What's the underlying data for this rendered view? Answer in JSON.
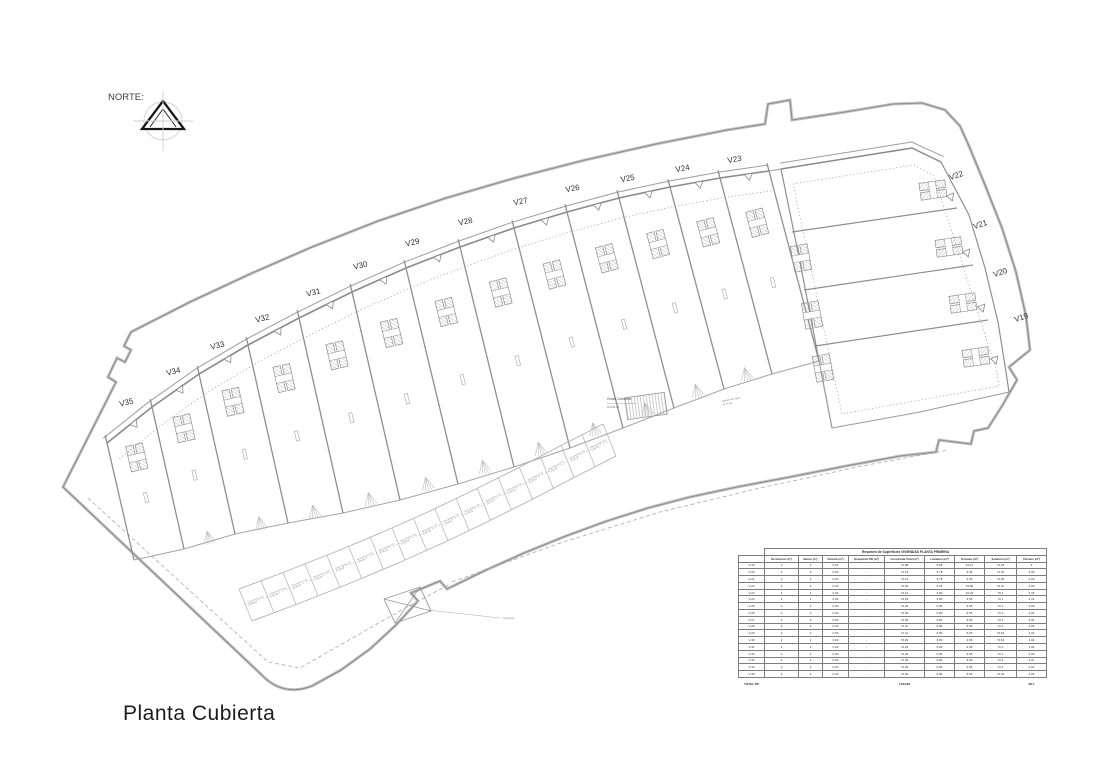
{
  "page": {
    "title_label": "Planta Cubierta",
    "north_label": "NORTE:"
  },
  "plan": {
    "villa_labels": [
      {
        "id": "V19",
        "x": 1022,
        "y": 320,
        "rot": -18
      },
      {
        "id": "V20",
        "x": 1001,
        "y": 275,
        "rot": -18
      },
      {
        "id": "V21",
        "x": 981,
        "y": 227,
        "rot": -18
      },
      {
        "id": "V22",
        "x": 957,
        "y": 178,
        "rot": -18
      },
      {
        "id": "V23",
        "x": 735,
        "y": 162,
        "rot": -10
      },
      {
        "id": "V24",
        "x": 683,
        "y": 171,
        "rot": -10
      },
      {
        "id": "V25",
        "x": 628,
        "y": 181,
        "rot": -10
      },
      {
        "id": "V26",
        "x": 573,
        "y": 191,
        "rot": -10
      },
      {
        "id": "V27",
        "x": 521,
        "y": 204,
        "rot": -11
      },
      {
        "id": "V28",
        "x": 466,
        "y": 224,
        "rot": -12
      },
      {
        "id": "V29",
        "x": 413,
        "y": 245,
        "rot": -13
      },
      {
        "id": "V30",
        "x": 361,
        "y": 268,
        "rot": -13
      },
      {
        "id": "V31",
        "x": 314,
        "y": 295,
        "rot": -14
      },
      {
        "id": "V32",
        "x": 263,
        "y": 321,
        "rot": -14
      },
      {
        "id": "V33",
        "x": 218,
        "y": 348,
        "rot": -14
      },
      {
        "id": "V34",
        "x": 174,
        "y": 374,
        "rot": -14
      },
      {
        "id": "V35",
        "x": 127,
        "y": 405,
        "rot": -14
      }
    ],
    "annotations": {
      "zonas_comunes": {
        "x": 607,
        "y": 400,
        "title": "Zonas Comunes",
        "line2": "Zonas peatonales y ajardinadas",
        "line3": "1572,00 m2"
      },
      "lamina_agua": {
        "x": 722,
        "y": 402,
        "rot": -11,
        "line1": "Lámina de agua",
        "line2": "87,50 m2"
      },
      "acometida": {
        "x": 503,
        "y": 619,
        "label": "Acometida"
      }
    },
    "parking": {
      "label_prefix": "Aparcamiento",
      "area_label": "12,50 m2",
      "villas": [
        "V35",
        "V34",
        "V33",
        "V32",
        "V31",
        "V30",
        "V29",
        "V28",
        "V27",
        "V26",
        "V25",
        "V24",
        "V23",
        "V22",
        "V21",
        "V20",
        "V19"
      ]
    },
    "geometry": {
      "site": "M 63 487 L 116 382 L 108 377 L 117 358 L 125 362 L 131 350 L 124 346 L 131 332 L 190 302 L 250 274 L 312 247 L 378 221 L 446 198 L 515 178 L 585 160 L 656 144 L 727 130 L 765 124 L 768 104 L 790 100 L 792 120 L 845 112 L 893 104 L 922 103 L 945 110 L 960 126 L 969 146 L 985 185 L 1002 228 L 1016 272 L 1026 316 L 1030 350 L 1009 367 L 1017 380 L 1002 406 L 988 428 L 974 431 L 971 444 L 939 440 L 936 452 L 900 456 L 846 466 L 790 477 L 737 487 L 690 497 L 648 508 L 607 521 L 566 536 L 524 553 L 484 571 L 447 589 L 440 581 L 411 593 L 418 601 L 396 625 L 370 649 L 341 670 L 312 686 Q 286 696 266 679 L 63 487 Z",
      "topEdge": [
        [
          107,
          443
        ],
        [
          152,
          407
        ],
        [
          199,
          374
        ],
        [
          248,
          345
        ],
        [
          299,
          318
        ],
        [
          352,
          292
        ],
        [
          406,
          268
        ],
        [
          460,
          247
        ],
        [
          514,
          228
        ],
        [
          567,
          212
        ],
        [
          619,
          198
        ],
        [
          670,
          187
        ],
        [
          720,
          178
        ],
        [
          769,
          171
        ]
      ],
      "bottomEdge": [
        [
          134,
          560
        ],
        [
          184,
          549
        ],
        [
          235,
          534
        ],
        [
          288,
          523
        ],
        [
          343,
          513
        ],
        [
          400,
          500
        ],
        [
          458,
          484
        ],
        [
          514,
          467
        ],
        [
          570,
          448
        ],
        [
          623,
          428
        ],
        [
          674,
          408
        ],
        [
          724,
          389
        ],
        [
          772,
          374
        ],
        [
          819,
          361
        ]
      ],
      "blockTop": [
        [
          781,
          169
        ],
        [
          912,
          148
        ],
        [
          941,
          162
        ]
      ],
      "blockRight": [
        [
          941,
          162
        ],
        [
          969,
          215
        ],
        [
          985,
          268
        ],
        [
          998,
          322
        ],
        [
          1006,
          372
        ],
        [
          1009,
          392
        ]
      ],
      "blockBottom": [
        [
          1009,
          392
        ],
        [
          920,
          412
        ],
        [
          832,
          428
        ]
      ],
      "blockLeft": [
        [
          832,
          428
        ],
        [
          816,
          345
        ],
        [
          800,
          262
        ],
        [
          781,
          169
        ]
      ],
      "blockInset": [
        [
          793,
          184
        ],
        [
          914,
          165
        ],
        [
          934,
          176
        ],
        [
          997,
          372
        ],
        [
          999,
          386
        ],
        [
          842,
          414
        ],
        [
          793,
          184
        ]
      ],
      "blockDividers": [
        [
          [
            792,
            232
          ],
          [
            957,
            208
          ]
        ],
        [
          [
            804,
            290
          ],
          [
            973,
            265
          ]
        ],
        [
          [
            815,
            346
          ],
          [
            988,
            320
          ]
        ]
      ],
      "blockCores": [
        [
          933,
          190,
          -8
        ],
        [
          949,
          247,
          -8
        ],
        [
          963,
          303,
          -8
        ],
        [
          976,
          357,
          -8
        ],
        [
          801,
          258,
          80
        ],
        [
          812,
          315,
          80
        ],
        [
          823,
          368,
          80
        ]
      ],
      "blockTriangles": [
        [
          953,
          197,
          100
        ],
        [
          969,
          253,
          100
        ],
        [
          984,
          308,
          101
        ],
        [
          997,
          360,
          102
        ]
      ],
      "parkingOuter": [
        [
          252,
          621
        ],
        [
          300,
          603
        ],
        [
          348,
          584
        ],
        [
          396,
          564
        ],
        [
          443,
          543
        ],
        [
          489,
          521
        ],
        [
          533,
          499
        ],
        [
          575,
          477
        ],
        [
          616,
          456
        ]
      ],
      "dashedA": [
        [
          88,
          498
        ],
        [
          268,
          662
        ],
        [
          300,
          668
        ],
        [
          398,
          612
        ],
        [
          450,
          584
        ]
      ],
      "dashedB": [
        [
          452,
          582
        ],
        [
          560,
          543
        ],
        [
          660,
          512
        ],
        [
          760,
          488
        ],
        [
          862,
          466
        ],
        [
          948,
          450
        ]
      ],
      "connectors": [
        [
          [
            769,
            171
          ],
          [
            781,
            169
          ]
        ],
        [
          [
            819,
            361
          ],
          [
            832,
            428
          ]
        ]
      ],
      "xbox": [
        [
          384,
          599
        ],
        [
          420,
          587
        ],
        [
          431,
          611
        ],
        [
          395,
          623
        ]
      ],
      "xboxLeader": [
        [
          428,
          610
        ],
        [
          500,
          618
        ]
      ],
      "zonasRect": [
        646,
        406,
        -8
      ]
    }
  },
  "table": {
    "title": "Resumen de Superficies VIVIENDAS PLANTA PRIMERA",
    "columns": [
      "Dormitorios (nº)",
      "Baños (nº)",
      "Parcela (m²)",
      "Ocupación PB (m²)",
      "Construida Total (m²)",
      "Lavadero (m²)",
      "Terrazas (m²)",
      "Solarium (m²)",
      "Trastero (m²)"
    ],
    "rows": [
      {
        "id": "V-19",
        "values": [
          "2",
          "2",
          "0,00",
          "-",
          "72,98",
          "5,08",
          "10,11",
          "74,04",
          "4"
        ]
      },
      {
        "id": "V-20",
        "values": [
          "2",
          "2",
          "0,00",
          "-",
          "71,13",
          "5,78",
          "9,35",
          "71,36",
          "4,09"
        ]
      },
      {
        "id": "V-21",
        "values": [
          "2",
          "2",
          "0,00",
          "-",
          "71,13",
          "5,78",
          "9,35",
          "72,36",
          "4,03"
        ]
      },
      {
        "id": "V-22",
        "values": [
          "2",
          "2",
          "0,00",
          "-",
          "72,93",
          "5,05",
          "10,50",
          "73,41",
          "4,05"
        ]
      },
      {
        "id": "V-23",
        "values": [
          "2",
          "2",
          "0,00",
          "-",
          "74,14",
          "6,80",
          "10,22",
          "75,4",
          "4,03"
        ]
      },
      {
        "id": "V-24",
        "values": [
          "2",
          "2",
          "0,00",
          "-",
          "72,29",
          "6,80",
          "9,56",
          "72,1",
          "4,14"
        ]
      },
      {
        "id": "V-25",
        "values": [
          "2",
          "2",
          "0,00",
          "-",
          "72,29",
          "6,80",
          "9,56",
          "72,1",
          "3,99"
        ]
      },
      {
        "id": "V-26",
        "values": [
          "2",
          "2",
          "0,00",
          "-",
          "72,29",
          "6,80",
          "9,56",
          "72,1",
          "4,04"
        ]
      },
      {
        "id": "V-27",
        "values": [
          "2",
          "2",
          "0,00",
          "-",
          "72,29",
          "6,80",
          "9,56",
          "72,1",
          "4,04"
        ]
      },
      {
        "id": "V-28",
        "values": [
          "2",
          "2",
          "0,00",
          "-",
          "71,41",
          "6,80",
          "9,05",
          "72,1",
          "4,04"
        ]
      },
      {
        "id": "V-29",
        "values": [
          "2",
          "2",
          "0,00",
          "-",
          "71,41",
          "6,80",
          "9,05",
          "74,64",
          "4,04"
        ]
      },
      {
        "id": "V-30",
        "values": [
          "2",
          "2",
          "0,00",
          "-",
          "72,29",
          "6,80",
          "9,56",
          "74,64",
          "4,04"
        ]
      },
      {
        "id": "V-31",
        "values": [
          "2",
          "2",
          "0,00",
          "-",
          "72,29",
          "6,80",
          "9,56",
          "72,1",
          "4,04"
        ]
      },
      {
        "id": "V-32",
        "values": [
          "2",
          "2",
          "0,00",
          "-",
          "72,29",
          "6,80",
          "9,56",
          "72,1",
          "4,06"
        ]
      },
      {
        "id": "V-33",
        "values": [
          "2",
          "2",
          "0,00",
          "-",
          "72,29",
          "6,80",
          "9,56",
          "72,1",
          "4,01"
        ]
      },
      {
        "id": "V-34",
        "values": [
          "2",
          "2",
          "0,00",
          "-",
          "72,29",
          "6,80",
          "9,56",
          "72,1",
          "4,01"
        ]
      },
      {
        "id": "V-35",
        "values": [
          "2",
          "2",
          "0,00",
          "-",
          "74,06",
          "6,80",
          "9,56",
          "74,33",
          "4,04"
        ]
      }
    ],
    "total": {
      "label": "TOTAL PP",
      "construida": "1233,80",
      "trastero": "68,7"
    }
  }
}
